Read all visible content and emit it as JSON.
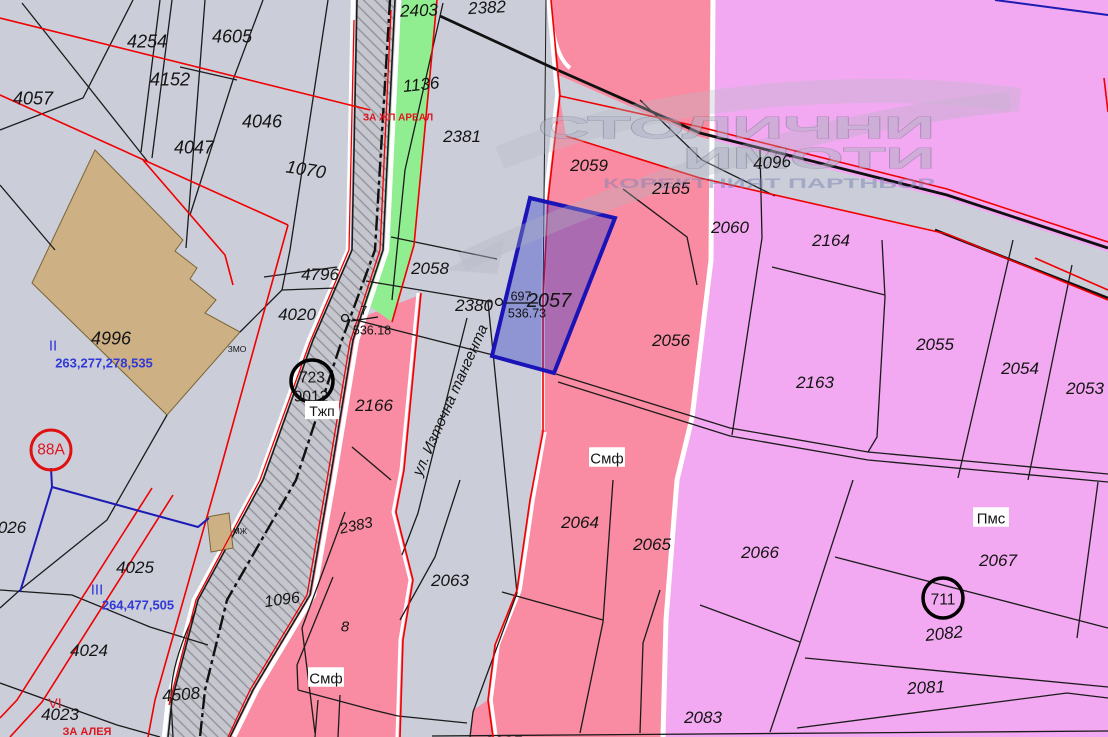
{
  "watermark": {
    "line1": "СТОЛИЧНИ",
    "line2": "ИМОТИ",
    "line3": "КОРЕКТНИЯТ ПАРТНЬОР"
  },
  "street_label": "ул. Източна тангента",
  "selected_parcel": {
    "number": "2057",
    "survey_point": "697",
    "elevation": "536.73"
  },
  "survey_point_secondary": {
    "number": "7",
    "elevation": "536.18"
  },
  "colors": {
    "base_gray": "#CBCDD9",
    "pink_zone": "#F98CA2",
    "magenta_zone": "#F2A9F1",
    "green_strip": "#90EE90",
    "building_tan": "#CDB185",
    "selected_blue_border": "#1A14B8",
    "red_line": "#F00000",
    "blue_line": "#1C1CB4",
    "blue_text": "#3038D8",
    "red_text": "#E0141E"
  },
  "labels": [
    {
      "t": "4254",
      "x": 147,
      "y": 41,
      "s": 18,
      "i": 1
    },
    {
      "t": "4605",
      "x": 232,
      "y": 36,
      "s": 18,
      "i": 1
    },
    {
      "t": "4152",
      "x": 170,
      "y": 79,
      "s": 18,
      "i": 1
    },
    {
      "t": "4057",
      "x": 33,
      "y": 98,
      "s": 18,
      "i": 1
    },
    {
      "t": "4046",
      "x": 262,
      "y": 121,
      "s": 18,
      "i": 1
    },
    {
      "t": "4047",
      "x": 194,
      "y": 147,
      "s": 18,
      "i": 1
    },
    {
      "t": "1070",
      "x": 306,
      "y": 169,
      "s": 18,
      "i": 1,
      "rot": 9
    },
    {
      "t": "4996",
      "x": 111,
      "y": 338,
      "s": 18,
      "i": 1
    },
    {
      "t": "II",
      "x": 53,
      "y": 345,
      "s": 15,
      "c": "#3038D8"
    },
    {
      "t": "263,277,278,535",
      "x": 104,
      "y": 363,
      "s": 13,
      "c": "#3038D8",
      "b": 1
    },
    {
      "t": "ЗМО",
      "x": 237,
      "y": 349,
      "s": 8.5
    },
    {
      "t": "4796",
      "x": 320,
      "y": 274,
      "s": 17,
      "i": 1
    },
    {
      "t": "4020",
      "x": 297,
      "y": 314,
      "s": 17,
      "i": 1
    },
    {
      "t": "723",
      "x": 312,
      "y": 377,
      "s": 15.5
    },
    {
      "t": "9012",
      "x": 311,
      "y": 396,
      "s": 15.5
    },
    {
      "t": "Тжп",
      "x": 322,
      "y": 411,
      "s": 14,
      "bg": 1
    },
    {
      "t": "88А",
      "x": 51,
      "y": 449,
      "s": 15.5,
      "c": "#E0141E"
    },
    {
      "t": "026",
      "x": 12,
      "y": 527,
      "s": 17,
      "i": 1
    },
    {
      "t": "4025",
      "x": 135,
      "y": 567,
      "s": 17,
      "i": 1
    },
    {
      "t": "III",
      "x": 97,
      "y": 589,
      "s": 15,
      "c": "#3038D8"
    },
    {
      "t": "264,477,505",
      "x": 138,
      "y": 605,
      "s": 13,
      "c": "#3038D8",
      "b": 1
    },
    {
      "t": "4024",
      "x": 89,
      "y": 650,
      "s": 17,
      "i": 1
    },
    {
      "t": "4508",
      "x": 181,
      "y": 694,
      "s": 17,
      "i": 1,
      "rot": -5
    },
    {
      "t": "VI",
      "x": 55,
      "y": 703,
      "s": 14,
      "c": "#E0141E"
    },
    {
      "t": "4023",
      "x": 60,
      "y": 714,
      "s": 17,
      "i": 1
    },
    {
      "t": "ЗА АЛЕЯ",
      "x": 87,
      "y": 731,
      "s": 11,
      "c": "#E0141E",
      "b": 1
    },
    {
      "t": "МЖ",
      "x": 240,
      "y": 531,
      "s": 8
    },
    {
      "t": "2403",
      "x": 419,
      "y": 10,
      "s": 17,
      "i": 1,
      "rot": -2
    },
    {
      "t": "2382",
      "x": 487,
      "y": 7,
      "s": 17,
      "i": 1,
      "rot": -3
    },
    {
      "t": "1136",
      "x": 421,
      "y": 84,
      "s": 17,
      "i": 1,
      "rot": -6
    },
    {
      "t": "ЗА ЖП АРЕАЛ",
      "x": 398,
      "y": 117,
      "s": 10,
      "c": "#E0141E",
      "b": 1
    },
    {
      "t": "2381",
      "x": 462,
      "y": 136,
      "s": 17,
      "i": 1
    },
    {
      "t": "2058",
      "x": 430,
      "y": 268,
      "s": 17,
      "i": 1
    },
    {
      "t": "2380",
      "x": 474,
      "y": 305,
      "s": 17,
      "i": 1
    },
    {
      "t": "697",
      "x": 521,
      "y": 296,
      "s": 12.5
    },
    {
      "t": "536.73",
      "x": 527,
      "y": 313,
      "s": 12.5
    },
    {
      "t": "2057",
      "x": 549,
      "y": 300,
      "s": 20,
      "i": 1
    },
    {
      "t": "7",
      "x": 364,
      "y": 310,
      "s": 12
    },
    {
      "t": "536.18",
      "x": 372,
      "y": 330,
      "s": 12.5
    },
    {
      "t": "2166",
      "x": 374,
      "y": 405,
      "s": 17,
      "i": 1
    },
    {
      "t": "2383",
      "x": 356,
      "y": 525,
      "s": 15,
      "i": 1,
      "rot": -12
    },
    {
      "t": "1096",
      "x": 282,
      "y": 599,
      "s": 16,
      "i": 1,
      "rot": -8
    },
    {
      "t": "8",
      "x": 345,
      "y": 626,
      "s": 15,
      "i": 1
    },
    {
      "t": "Смф",
      "x": 326,
      "y": 678,
      "s": 15,
      "bg": 1
    },
    {
      "t": "2063",
      "x": 450,
      "y": 580,
      "s": 17,
      "i": 1
    },
    {
      "t": "2085",
      "x": 503,
      "y": 742,
      "s": 17,
      "i": 1
    },
    {
      "t": "2059",
      "x": 589,
      "y": 165,
      "s": 17,
      "i": 1
    },
    {
      "t": "2165",
      "x": 671,
      "y": 188,
      "s": 17,
      "i": 1
    },
    {
      "t": "2056",
      "x": 671,
      "y": 340,
      "s": 17,
      "i": 1
    },
    {
      "t": "Смф",
      "x": 607,
      "y": 458,
      "s": 15,
      "bg": 1
    },
    {
      "t": "2064",
      "x": 580,
      "y": 522,
      "s": 17,
      "i": 1
    },
    {
      "t": "2065",
      "x": 652,
      "y": 544,
      "s": 17,
      "i": 1
    },
    {
      "t": "4096",
      "x": 772,
      "y": 162,
      "s": 17,
      "i": 1,
      "rot": -4
    },
    {
      "t": "2060",
      "x": 730,
      "y": 227,
      "s": 17,
      "i": 1
    },
    {
      "t": "2164",
      "x": 831,
      "y": 240,
      "s": 17,
      "i": 1
    },
    {
      "t": "2163",
      "x": 815,
      "y": 382,
      "s": 17,
      "i": 1
    },
    {
      "t": "2055",
      "x": 935,
      "y": 344,
      "s": 17,
      "i": 1
    },
    {
      "t": "2054",
      "x": 1020,
      "y": 368,
      "s": 17,
      "i": 1
    },
    {
      "t": "2053",
      "x": 1085,
      "y": 388,
      "s": 17,
      "i": 1
    },
    {
      "t": "2066",
      "x": 760,
      "y": 552,
      "s": 17,
      "i": 1
    },
    {
      "t": "Пмс",
      "x": 991,
      "y": 518,
      "s": 15,
      "bg": 1
    },
    {
      "t": "2067",
      "x": 998,
      "y": 560,
      "s": 17,
      "i": 1
    },
    {
      "t": "711",
      "x": 943,
      "y": 599,
      "s": 15.5
    },
    {
      "t": "2082",
      "x": 944,
      "y": 633,
      "s": 17,
      "i": 1,
      "rot": -6
    },
    {
      "t": "2081",
      "x": 926,
      "y": 687,
      "s": 17,
      "i": 1,
      "rot": -3
    },
    {
      "t": "2083",
      "x": 703,
      "y": 717,
      "s": 17,
      "i": 1
    }
  ]
}
